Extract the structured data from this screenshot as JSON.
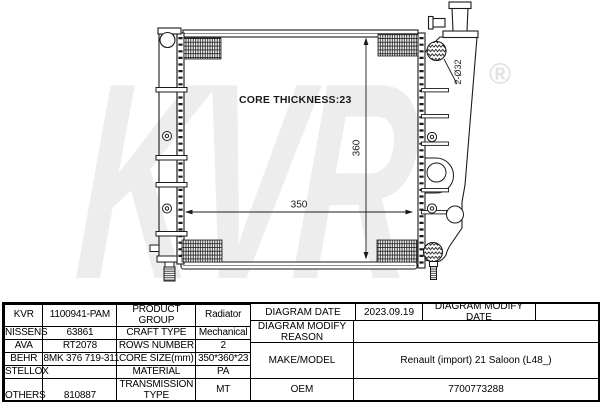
{
  "diagram": {
    "watermark_text": "KVR",
    "registered_symbol": "®",
    "core_thickness_label": "CORE THICKNESS:23",
    "core_width": "350",
    "core_height": "360",
    "inlet_size": "2-Ø32"
  },
  "spec_table": {
    "brands": [
      {
        "name": "KVR",
        "part_number": "1100941-PAM"
      },
      {
        "name": "NISSENS",
        "part_number": "63861"
      },
      {
        "name": "AVA",
        "part_number": "RT2078"
      },
      {
        "name": "BEHR",
        "part_number": "8MK 376 719-311"
      },
      {
        "name": "STELLOX",
        "part_number": ""
      },
      {
        "name": "OTHERS",
        "part_number": "810887"
      }
    ],
    "attributes": [
      {
        "label": "PRODUCT GROUP",
        "value": "Radiator"
      },
      {
        "label": "CRAFT TYPE",
        "value": "Mechanical"
      },
      {
        "label": "ROWS NUMBER",
        "value": "2"
      },
      {
        "label": "CORE SIZE(mm)",
        "value": "350*360*23"
      },
      {
        "label": "MATERIAL",
        "value": "PA"
      },
      {
        "label": "TRANSMISSION TYPE",
        "value": "MT"
      },
      {
        "label": "SUPPLEMENTARY",
        "value": ""
      }
    ],
    "info": {
      "diagram_date_label": "DIAGRAM DATE",
      "diagram_date": "2023.09.19",
      "diagram_modify_date_label": "DIAGRAM MODIFY DATE",
      "diagram_modify_date": "",
      "diagram_modify_reason_label": "DIAGRAM MODIFY REASON",
      "diagram_modify_reason": "",
      "make_model_label": "MAKE/MODEL",
      "make_model": "Renault (import) 21 Saloon (L48_)",
      "oem_label": "OEM",
      "oem": "7700773288"
    }
  }
}
